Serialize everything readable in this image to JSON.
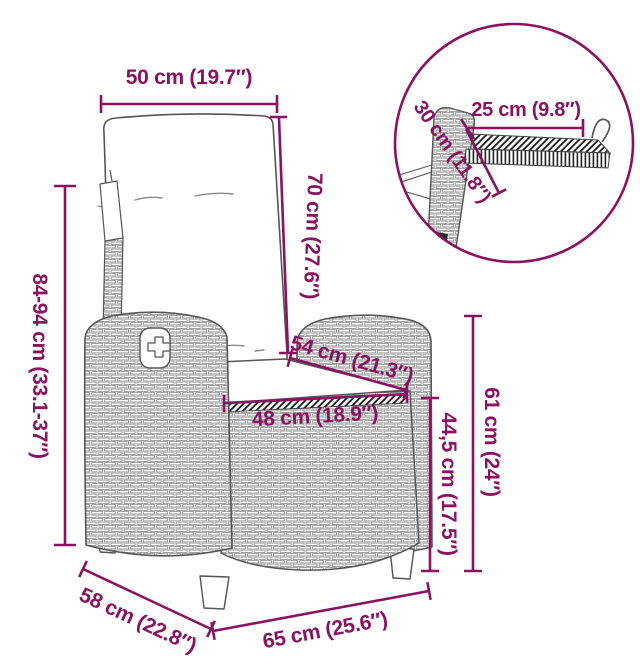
{
  "figure": {
    "type": "product-dimension-diagram",
    "subject": "reclining wicker garden chair with cushions and fold-out side table"
  },
  "colors": {
    "dimension_accent": "#8A1260",
    "artwork_line": "#555555"
  },
  "dimensions": {
    "top_width": "50 cm (19.7″)",
    "backrest_height": "70 cm (27.6″)",
    "overall_height": "84-94 cm (33.1-37″)",
    "seat_diagonal": "54 cm (21.3″)",
    "seat_width": "48 cm (18.9″)",
    "seat_height": "44,5 cm (17.5″)",
    "armrest_height": "61 cm (24″)",
    "seat_depth": "58 cm (22.8″)",
    "overall_width": "65 cm (25.6″)",
    "detail_table_width": "25 cm (9.8″)",
    "detail_table_depth": "30 cm (11.8″)"
  }
}
